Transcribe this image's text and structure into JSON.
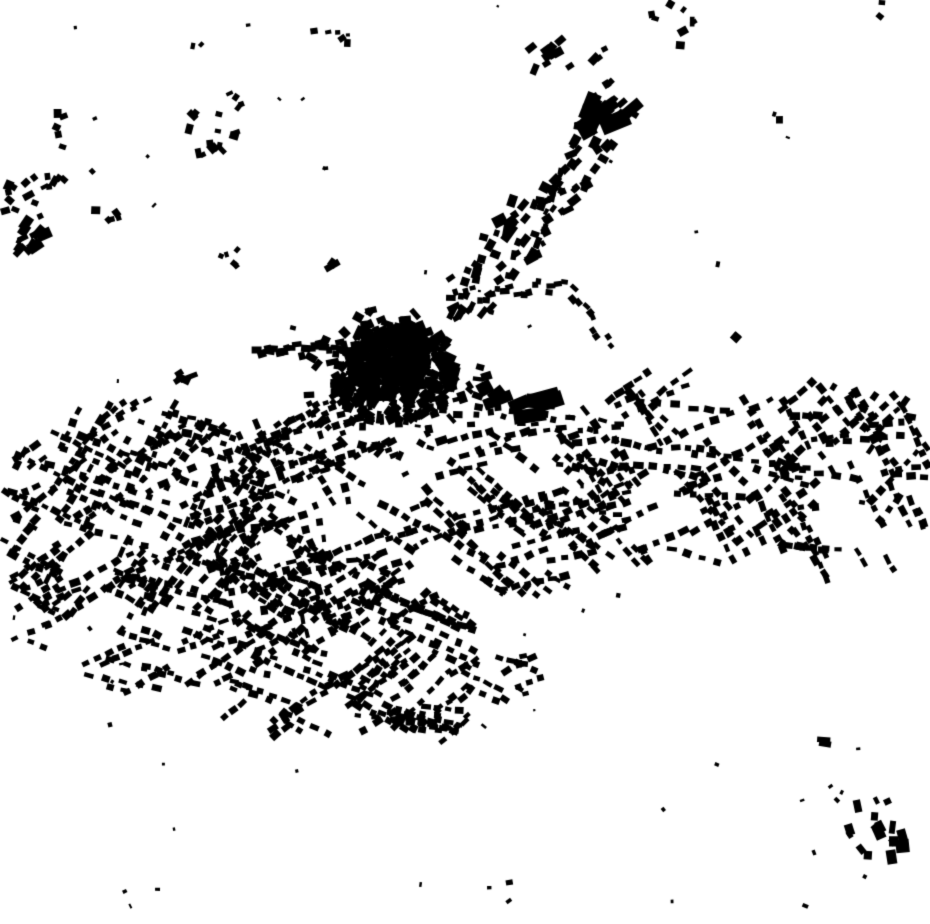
{
  "palette": {
    "background": "#ffffff",
    "building": "#000000"
  },
  "map": {
    "width": 930,
    "height": 924,
    "seed": 1347,
    "clusters": [
      {
        "name": "old-town-core",
        "type": "blob",
        "cx": 393,
        "cy": 372,
        "rx": 64,
        "ry": 52,
        "count": 260,
        "w": [
          5,
          15
        ],
        "h": [
          4,
          12
        ],
        "jitter": 90
      },
      {
        "name": "old-town-inner",
        "type": "blob",
        "cx": 390,
        "cy": 362,
        "rx": 42,
        "ry": 34,
        "count": 150,
        "w": [
          6,
          16
        ],
        "h": [
          5,
          12
        ],
        "jitter": 90
      },
      {
        "name": "old-town-ring",
        "type": "blob",
        "cx": 396,
        "cy": 378,
        "rx": 96,
        "ry": 78,
        "count": 85,
        "w": [
          5,
          12
        ],
        "h": [
          4,
          9
        ],
        "jitter": 90
      },
      {
        "name": "big-blocks-se",
        "type": "blob",
        "cx": 521,
        "cy": 404,
        "rx": 30,
        "ry": 16,
        "count": 6,
        "w": [
          16,
          34
        ],
        "h": [
          10,
          16
        ],
        "angle": -12,
        "jitter": 18
      },
      {
        "name": "big-block-pair",
        "type": "blob",
        "cx": 489,
        "cy": 391,
        "rx": 10,
        "ry": 8,
        "count": 2,
        "w": [
          14,
          22
        ],
        "h": [
          12,
          16
        ],
        "angle": -30,
        "jitter": 15
      },
      {
        "name": "ne-arm",
        "type": "strip",
        "x1": 452,
        "y1": 315,
        "x2": 628,
        "y2": 95,
        "count": 85,
        "spread": 26,
        "w": [
          6,
          13
        ],
        "h": [
          5,
          10
        ],
        "jitter": 30
      },
      {
        "name": "ne-arm-bigs",
        "type": "blob",
        "cx": 606,
        "cy": 112,
        "rx": 28,
        "ry": 24,
        "count": 7,
        "w": [
          12,
          30
        ],
        "h": [
          10,
          20
        ],
        "angle": -45,
        "jitter": 25
      },
      {
        "name": "ne-arm-beads",
        "type": "strip",
        "x1": 540,
        "y1": 232,
        "x2": 566,
        "y2": 168,
        "count": 12,
        "spread": 4,
        "w": [
          5,
          8
        ],
        "h": [
          4,
          6
        ],
        "jitter": 15
      },
      {
        "name": "ne-cross-building",
        "type": "blob",
        "cx": 509,
        "cy": 224,
        "rx": 12,
        "ry": 10,
        "count": 3,
        "w": [
          10,
          24
        ],
        "h": [
          8,
          12
        ],
        "angle": -45,
        "jitter": 20
      },
      {
        "name": "ne-l-building",
        "type": "blob",
        "cx": 524,
        "cy": 256,
        "rx": 12,
        "ry": 8,
        "count": 3,
        "w": [
          9,
          20
        ],
        "h": [
          7,
          11
        ],
        "angle": -40,
        "jitter": 20
      },
      {
        "name": "north-cluster",
        "type": "blob",
        "cx": 566,
        "cy": 57,
        "rx": 46,
        "ry": 25,
        "count": 13,
        "w": [
          6,
          12
        ],
        "h": [
          5,
          9
        ],
        "angle": -45,
        "jitter": 25
      },
      {
        "name": "north-right-cluster",
        "type": "blob",
        "cx": 668,
        "cy": 30,
        "rx": 30,
        "ry": 27,
        "count": 8,
        "w": [
          5,
          10
        ],
        "h": [
          4,
          8
        ],
        "jitter": 90
      },
      {
        "name": "west-ribbon",
        "type": "strip",
        "x1": 352,
        "y1": 347,
        "x2": 256,
        "y2": 353,
        "count": 22,
        "spread": 7,
        "w": [
          6,
          11
        ],
        "h": [
          5,
          8
        ],
        "jitter": 14
      },
      {
        "name": "sw-road-chain",
        "type": "strip",
        "x1": 350,
        "y1": 390,
        "x2": 252,
        "y2": 448,
        "count": 30,
        "spread": 9,
        "w": [
          5,
          10
        ],
        "h": [
          4,
          7
        ],
        "jitter": 14
      },
      {
        "name": "east-road-upper",
        "type": "strip",
        "x1": 448,
        "y1": 298,
        "x2": 568,
        "y2": 286,
        "count": 20,
        "spread": 8,
        "w": [
          5,
          10
        ],
        "h": [
          4,
          7
        ],
        "jitter": 14
      },
      {
        "name": "east-road-bend",
        "type": "strip",
        "x1": 568,
        "y1": 288,
        "x2": 612,
        "y2": 348,
        "count": 10,
        "spread": 7,
        "w": [
          5,
          9
        ],
        "h": [
          4,
          7
        ],
        "jitter": 14
      },
      {
        "name": "east-chain",
        "type": "strip",
        "x1": 470,
        "y1": 412,
        "x2": 625,
        "y2": 430,
        "count": 20,
        "spread": 9,
        "w": [
          5,
          10
        ],
        "h": [
          4,
          7
        ],
        "jitter": 14
      },
      {
        "name": "west-l-building",
        "type": "blob",
        "cx": 187,
        "cy": 379,
        "rx": 10,
        "ry": 11,
        "count": 4,
        "w": [
          6,
          20
        ],
        "h": [
          5,
          8
        ],
        "angle": 0,
        "jitter": 45
      },
      {
        "name": "nw-hamlet-main",
        "type": "blob",
        "cx": 32,
        "cy": 212,
        "rx": 30,
        "ry": 48,
        "count": 18,
        "w": [
          5,
          12
        ],
        "h": [
          4,
          9
        ],
        "angle": -40,
        "jitter": 30
      },
      {
        "name": "nw-hamlet-barns",
        "type": "blob",
        "cx": 30,
        "cy": 238,
        "rx": 22,
        "ry": 17,
        "count": 7,
        "w": [
          8,
          17
        ],
        "h": [
          6,
          12
        ],
        "angle": -40,
        "jitter": 25
      },
      {
        "name": "nw-hamlet-b",
        "type": "blob",
        "cx": 60,
        "cy": 131,
        "rx": 16,
        "ry": 18,
        "count": 5,
        "w": [
          5,
          10
        ],
        "h": [
          4,
          8
        ],
        "jitter": 90
      },
      {
        "name": "nw-hamlet-c",
        "type": "blob",
        "cx": 57,
        "cy": 186,
        "rx": 16,
        "ry": 13,
        "count": 5,
        "w": [
          5,
          10
        ],
        "h": [
          4,
          8
        ],
        "jitter": 90
      },
      {
        "name": "nw-hamlet-d",
        "type": "blob",
        "cx": 104,
        "cy": 212,
        "rx": 16,
        "ry": 20,
        "count": 5,
        "w": [
          5,
          10
        ],
        "h": [
          4,
          8
        ],
        "jitter": 90
      },
      {
        "name": "nw-hamlet-e",
        "type": "blob",
        "cx": 212,
        "cy": 134,
        "rx": 34,
        "ry": 26,
        "count": 14,
        "w": [
          5,
          11
        ],
        "h": [
          4,
          8
        ],
        "jitter": 90
      },
      {
        "name": "nw-hamlet-f",
        "type": "blob",
        "cx": 232,
        "cy": 101,
        "rx": 16,
        "ry": 9,
        "count": 4,
        "w": [
          4,
          9
        ],
        "h": [
          3,
          7
        ],
        "jitter": 90
      },
      {
        "name": "top-center-cluster",
        "type": "blob",
        "cx": 327,
        "cy": 37,
        "rx": 26,
        "ry": 10,
        "count": 6,
        "w": [
          4,
          9
        ],
        "h": [
          3,
          7
        ],
        "jitter": 90
      },
      {
        "name": "top-left-pair",
        "type": "blob",
        "cx": 196,
        "cy": 47,
        "rx": 7,
        "ry": 7,
        "count": 2,
        "w": [
          4,
          8
        ],
        "h": [
          3,
          6
        ],
        "jitter": 90
      },
      {
        "name": "top-left-dot",
        "type": "blob",
        "cx": 76,
        "cy": 29,
        "rx": 3,
        "ry": 3,
        "count": 1,
        "w": [
          3,
          4
        ],
        "h": [
          3,
          4
        ],
        "jitter": 90
      },
      {
        "name": "mid-left-dots",
        "type": "blob",
        "cx": 230,
        "cy": 258,
        "rx": 20,
        "ry": 9,
        "count": 5,
        "w": [
          4,
          8
        ],
        "h": [
          3,
          6
        ],
        "jitter": 90
      },
      {
        "name": "mid-left-bar",
        "type": "blob",
        "cx": 334,
        "cy": 265,
        "rx": 5,
        "ry": 5,
        "count": 2,
        "w": [
          8,
          16
        ],
        "h": [
          6,
          10
        ],
        "angle": -40,
        "jitter": 15
      },
      {
        "name": "lone-north-east",
        "type": "blob",
        "cx": 779,
        "cy": 120,
        "rx": 3,
        "ry": 3,
        "count": 1,
        "w": [
          6,
          8
        ],
        "h": [
          6,
          8
        ],
        "jitter": 20
      },
      {
        "name": "top-right-dots",
        "type": "blob",
        "cx": 878,
        "cy": 12,
        "rx": 12,
        "ry": 10,
        "count": 2,
        "w": [
          4,
          7
        ],
        "h": [
          3,
          6
        ],
        "jitter": 90
      },
      {
        "name": "mid-right-pair",
        "type": "blob",
        "cx": 737,
        "cy": 337,
        "rx": 6,
        "ry": 7,
        "count": 2,
        "w": [
          6,
          10
        ],
        "h": [
          5,
          9
        ],
        "jitter": 90
      },
      {
        "name": "sprawl-west",
        "type": "rows",
        "cx": 130,
        "cy": 520,
        "rx": 135,
        "ry": 115,
        "rows": 90,
        "maxPerRow": 8,
        "angles": [
          -30,
          20,
          -60
        ],
        "w": [
          6,
          11
        ],
        "h": [
          4,
          8
        ]
      },
      {
        "name": "sprawl-west-center",
        "type": "rows",
        "cx": 300,
        "cy": 520,
        "rx": 120,
        "ry": 110,
        "rows": 75,
        "maxPerRow": 7,
        "angles": [
          -20,
          30,
          70
        ],
        "w": [
          6,
          11
        ],
        "h": [
          4,
          8
        ]
      },
      {
        "name": "sprawl-south-center",
        "type": "rows",
        "cx": 320,
        "cy": 650,
        "rx": 150,
        "ry": 95,
        "rows": 65,
        "maxPerRow": 7,
        "angles": [
          -35,
          25
        ],
        "w": [
          6,
          11
        ],
        "h": [
          4,
          8
        ]
      },
      {
        "name": "sprawl-central-east",
        "type": "rows",
        "cx": 520,
        "cy": 505,
        "rx": 110,
        "ry": 85,
        "rows": 55,
        "maxPerRow": 6,
        "angles": [
          -15,
          40
        ],
        "w": [
          6,
          11
        ],
        "h": [
          4,
          8
        ]
      },
      {
        "name": "sprawl-east",
        "type": "rows",
        "cx": 670,
        "cy": 470,
        "rx": 130,
        "ry": 95,
        "rows": 60,
        "maxPerRow": 6,
        "angles": [
          -30,
          10,
          55
        ],
        "w": [
          6,
          11
        ],
        "h": [
          4,
          8
        ]
      },
      {
        "name": "sprawl-far-east",
        "type": "rows",
        "cx": 840,
        "cy": 480,
        "rx": 95,
        "ry": 100,
        "rows": 45,
        "maxPerRow": 6,
        "angles": [
          0,
          -45,
          60
        ],
        "w": [
          6,
          11
        ],
        "h": [
          4,
          8
        ]
      },
      {
        "name": "sprawl-tail-south",
        "type": "rows",
        "cx": 395,
        "cy": 700,
        "rx": 75,
        "ry": 55,
        "rows": 20,
        "maxPerRow": 6,
        "angles": [
          -40,
          10
        ],
        "w": [
          6,
          10
        ],
        "h": [
          4,
          7
        ]
      },
      {
        "name": "sprawl-se-pocket",
        "type": "rows",
        "cx": 500,
        "cy": 672,
        "rx": 40,
        "ry": 30,
        "rows": 10,
        "maxPerRow": 5,
        "angles": [
          20,
          -20
        ],
        "w": [
          6,
          10
        ],
        "h": [
          4,
          7
        ]
      },
      {
        "name": "sprawl-left-edge",
        "type": "rows",
        "cx": 25,
        "cy": 560,
        "rx": 42,
        "ry": 105,
        "rows": 16,
        "maxPerRow": 5,
        "angles": [
          -30,
          30
        ],
        "w": [
          6,
          10
        ],
        "h": [
          4,
          7
        ]
      },
      {
        "name": "sprawl-south-arc",
        "type": "rows",
        "cx": 170,
        "cy": 655,
        "rx": 110,
        "ry": 45,
        "rows": 18,
        "maxPerRow": 6,
        "angles": [
          -25,
          15
        ],
        "w": [
          6,
          10
        ],
        "h": [
          4,
          7
        ]
      },
      {
        "name": "se-hamlet",
        "type": "blob",
        "cx": 876,
        "cy": 830,
        "rx": 32,
        "ry": 38,
        "count": 12,
        "w": [
          5,
          13
        ],
        "h": [
          4,
          9
        ],
        "angle": 75,
        "jitter": 30
      },
      {
        "name": "se-hamlet-bigs",
        "type": "blob",
        "cx": 890,
        "cy": 842,
        "rx": 18,
        "ry": 20,
        "count": 5,
        "w": [
          10,
          18
        ],
        "h": [
          8,
          14
        ],
        "angle": 80,
        "jitter": 20
      },
      {
        "name": "se-pair",
        "type": "blob",
        "cx": 826,
        "cy": 747,
        "rx": 7,
        "ry": 9,
        "count": 2,
        "w": [
          11,
          14
        ],
        "h": [
          5,
          7
        ],
        "angle": 0,
        "jitter": 10
      },
      {
        "name": "se-dots",
        "type": "blob",
        "cx": 833,
        "cy": 793,
        "rx": 9,
        "ry": 9,
        "count": 3,
        "w": [
          3,
          6
        ],
        "h": [
          3,
          5
        ],
        "jitter": 90
      },
      {
        "name": "south-dots",
        "type": "blob",
        "cx": 500,
        "cy": 885,
        "rx": 28,
        "ry": 38,
        "count": 3,
        "w": [
          3,
          7
        ],
        "h": [
          3,
          6
        ],
        "jitter": 90
      },
      {
        "name": "lone-south-east",
        "type": "blob",
        "cx": 717,
        "cy": 763,
        "rx": 2,
        "ry": 2,
        "count": 1,
        "w": [
          4,
          5
        ],
        "h": [
          3,
          4
        ],
        "jitter": 90
      },
      {
        "name": "isolated-specks",
        "type": "scatter",
        "count": 60,
        "w": [
          2,
          6
        ],
        "h": [
          2,
          5
        ]
      }
    ]
  }
}
